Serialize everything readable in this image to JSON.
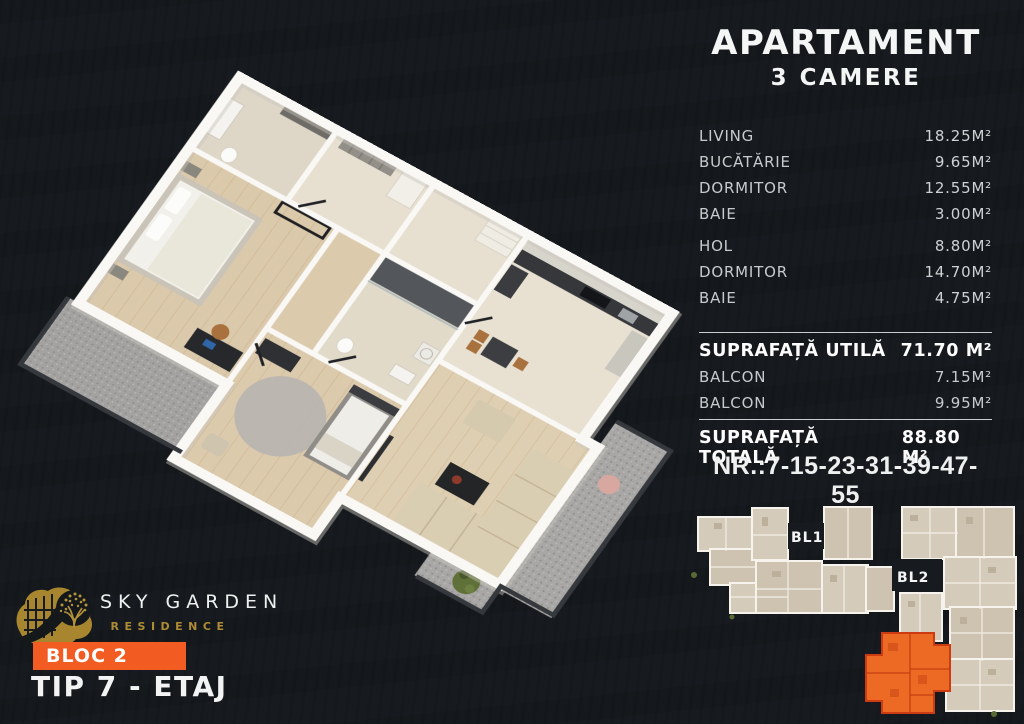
{
  "title": {
    "line1": "APARTAMENT",
    "line2": "3 CAMERE"
  },
  "rooms": [
    {
      "label": "LIVING",
      "area": "18.25M²"
    },
    {
      "label": "BUCĂTĂRIE",
      "area": "9.65M²"
    },
    {
      "label": "DORMITOR",
      "area": "12.55M²"
    },
    {
      "label": "BAIE",
      "area": "3.00M²"
    },
    {
      "label": "HOL",
      "area": "8.80M²"
    },
    {
      "label": "DORMITOR",
      "area": "14.70M²"
    },
    {
      "label": "BAIE",
      "area": "4.75M²"
    }
  ],
  "summary": {
    "utila_label": "SUPRAFAȚĂ UTILĂ",
    "utila_value": "71.70 M²",
    "balcon1_label": "BALCON",
    "balcon1_value": "7.15M²",
    "balcon2_label": "BALCON",
    "balcon2_value": "9.95M²",
    "totala_label": "SUPRAFAȚĂ TOTALĂ",
    "totala_value": "88.80 M²"
  },
  "unit_numbers": "NR.:7-15-23-31-39-47-55",
  "site_plan": {
    "bl1": "BL1",
    "bl2": "BL2"
  },
  "logo": {
    "name": "SKY GARDEN",
    "sub": "RESIDENCE"
  },
  "block_badge": "BLOC 2",
  "type_label": "TIP 7 - ETAJ",
  "colors": {
    "background": "#171B1F",
    "accent_orange": "#F25B22",
    "highlight_unit": "#EC6A24",
    "logo_gold": "#AB8B33",
    "text_light": "#C7CBCD",
    "white": "#F5F6F6"
  }
}
